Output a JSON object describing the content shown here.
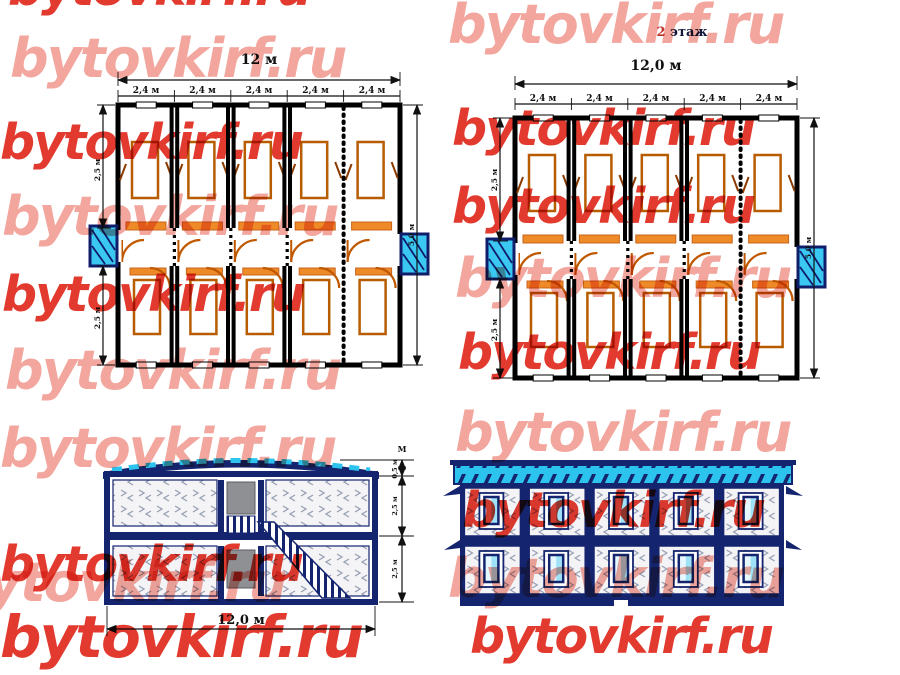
{
  "watermark": {
    "text": "bytovkirf.ru",
    "pink_color": "#f2a69d",
    "red_color": "#e23a2e"
  },
  "plan_first_floor": {
    "total_dim": "12 м",
    "segments": [
      "2,4 м",
      "2,4 м",
      "2,4 м",
      "2,4 м",
      "2,4 м"
    ],
    "left_dim_top": "2,5 м",
    "left_dim_bottom": "2,5 м",
    "right_dim": "5,0 м"
  },
  "plan_second_floor": {
    "title_number": "2",
    "title_word": " этаж",
    "total_dim": "12,0 м",
    "segments": [
      "2,4 м",
      "2,4 м",
      "2,4 м",
      "2,4 м",
      "2,4 м"
    ],
    "left_dim_top": "2,5 м",
    "left_dim_bottom": "2,5 м",
    "right_dim": "5,0 м"
  },
  "section": {
    "bottom_dim": "12,0 м",
    "unit_label": "М",
    "height_dims": [
      "0,5 м",
      "2,5 м",
      "2,5 м"
    ]
  },
  "facade": {
    "floors": 2,
    "windows_per_floor": 5
  },
  "colors": {
    "navy": "#15246e",
    "roof_cyan": "#2cc4ee",
    "porch_cyan": "#3ac8f3",
    "furniture_orange": "#ef8a28",
    "wall_black": "#000000"
  }
}
